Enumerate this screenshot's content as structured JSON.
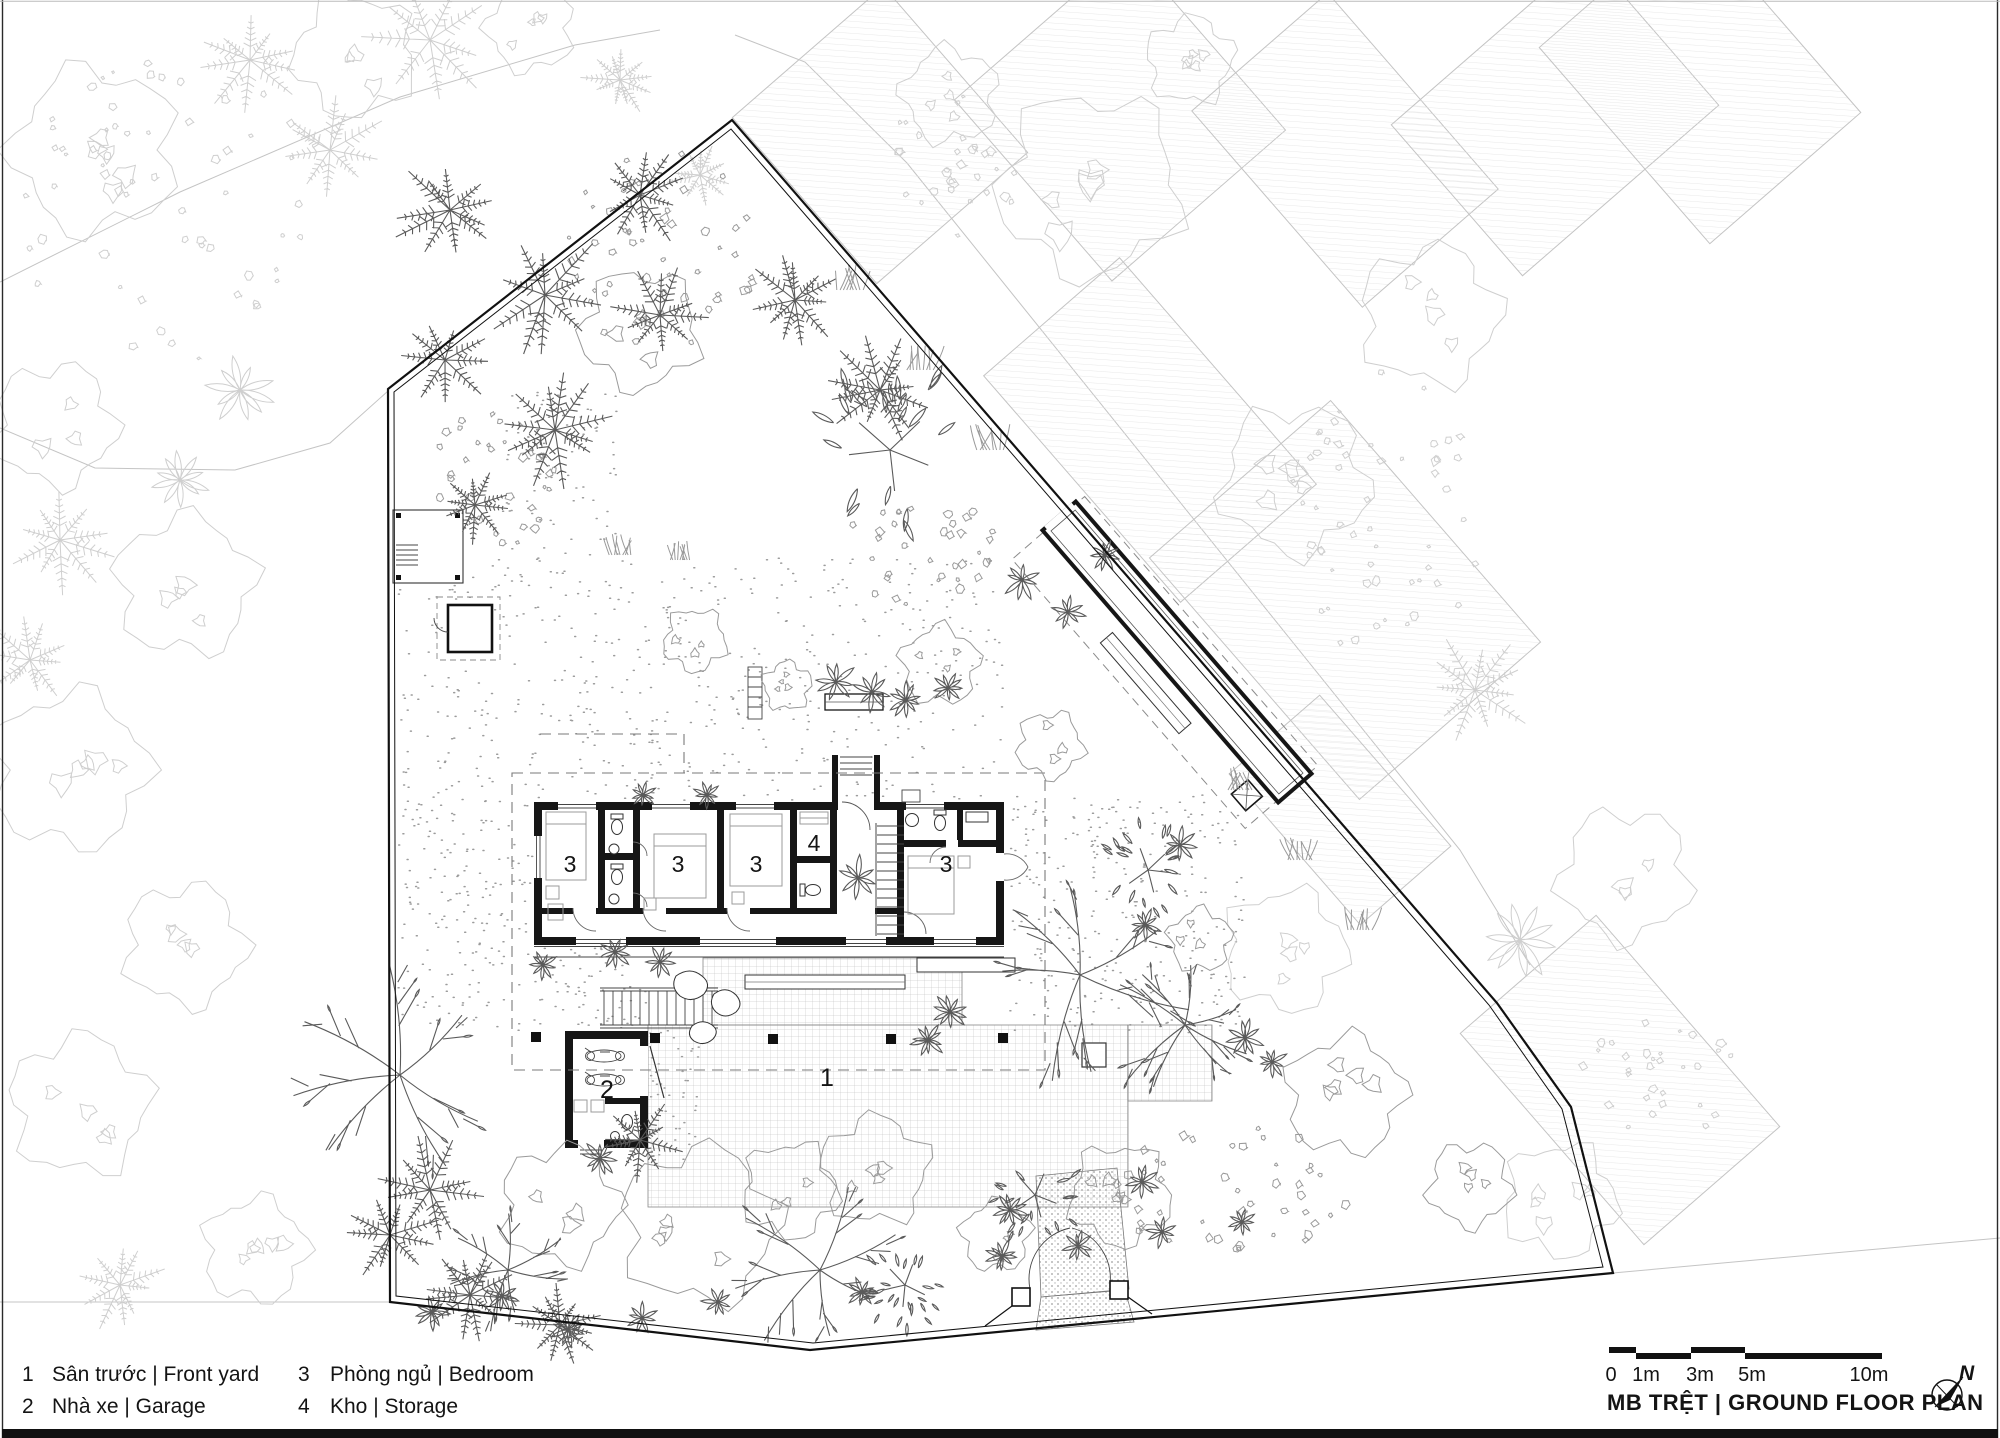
{
  "colors": {
    "ink": "#161616",
    "light_veg": "#cfcfcf",
    "mid_veg": "#9a9a9a",
    "dark_veg": "#5a5a5a",
    "paper": "#ffffff"
  },
  "legend": {
    "items": [
      {
        "number": "1",
        "label": "Sân trước | Front yard"
      },
      {
        "number": "2",
        "label": "Nhà xe | Garage"
      },
      {
        "number": "3",
        "label": "Phòng ngủ | Bedroom"
      },
      {
        "number": "4",
        "label": "Kho | Storage"
      }
    ]
  },
  "plan": {
    "marks": [
      {
        "id": "front-yard",
        "number": "1"
      },
      {
        "id": "garage",
        "number": "2"
      },
      {
        "id": "bedroom-1",
        "number": "3"
      },
      {
        "id": "bedroom-2",
        "number": "3"
      },
      {
        "id": "bedroom-3",
        "number": "3"
      },
      {
        "id": "storage",
        "number": "4"
      },
      {
        "id": "bedroom-4",
        "number": "3"
      }
    ]
  },
  "scale_bar": {
    "labels": [
      "0",
      "1m",
      "3m",
      "5m",
      "10m"
    ]
  },
  "title_block": {
    "title": "MB TRỆT | GROUND FLOOR PLAN"
  },
  "north": {
    "label": "N"
  }
}
